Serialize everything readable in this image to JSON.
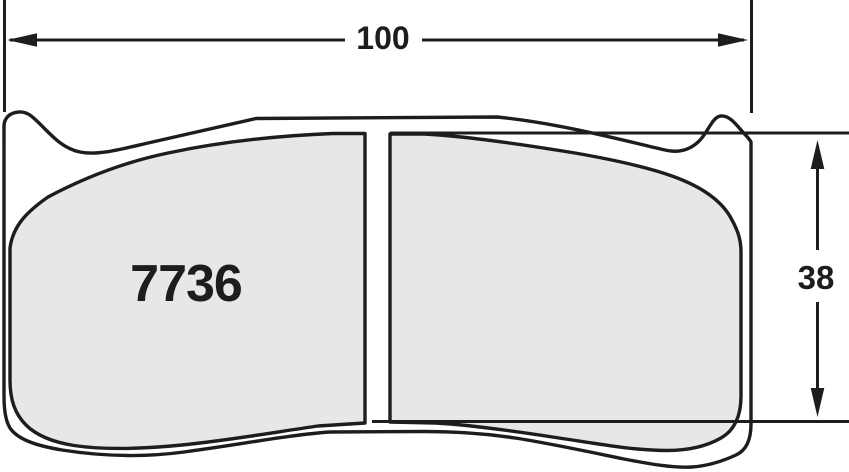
{
  "drawing": {
    "part_number": "7736",
    "width_dimension": "100",
    "height_dimension": "38",
    "colors": {
      "line": "#1d1d1b",
      "pad_fill": "#e6e7e8",
      "plate_fill": "#ffffff",
      "background": "#ffffff"
    }
  }
}
